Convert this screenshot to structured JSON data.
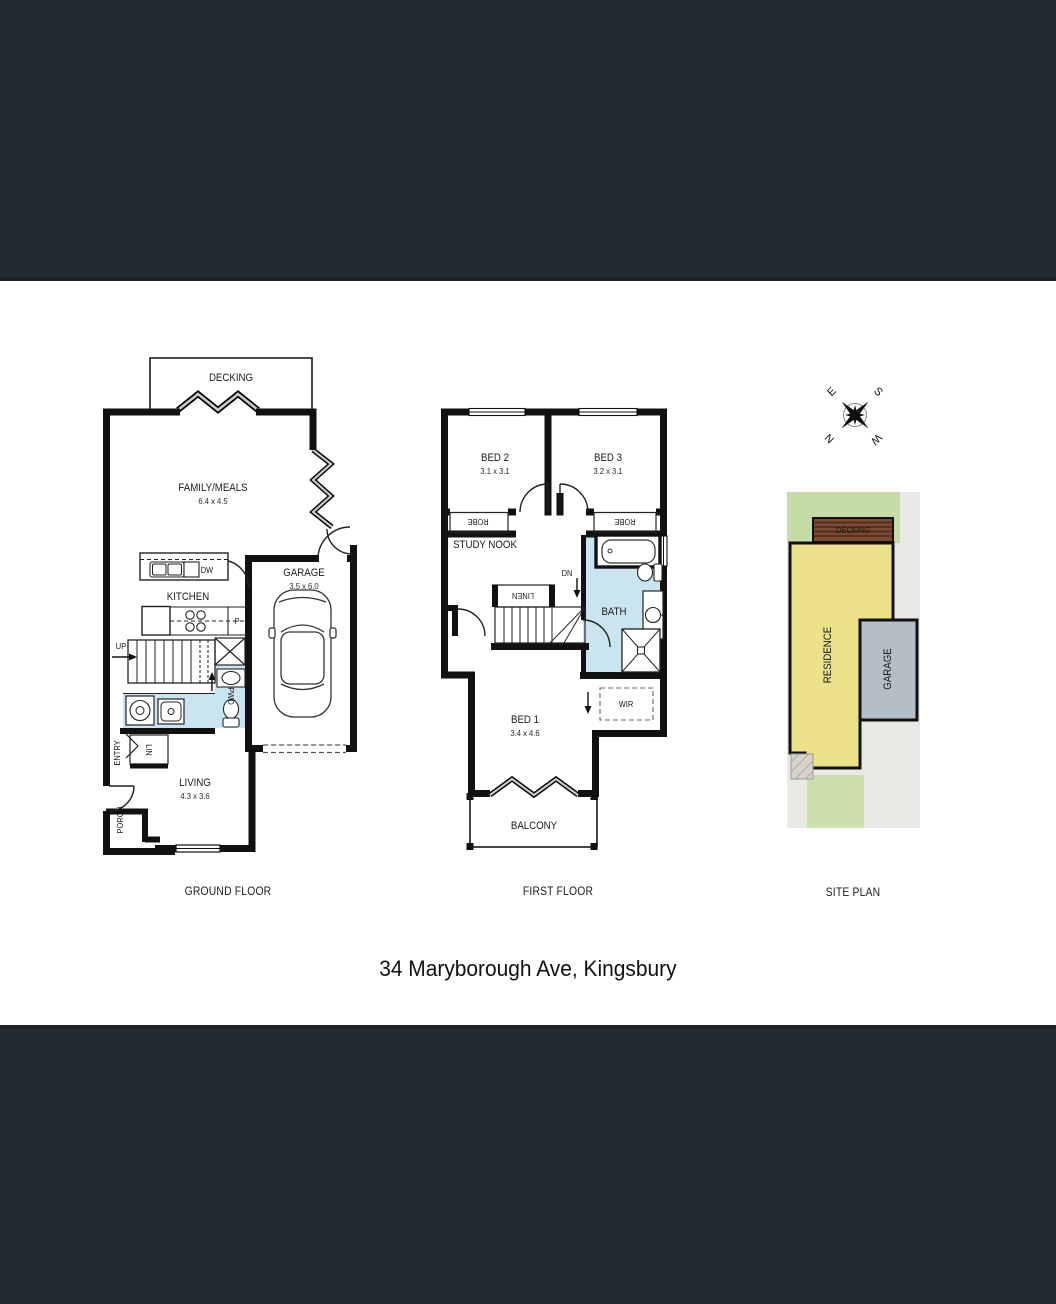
{
  "ground": {
    "title": "GROUND FLOOR",
    "decking": "DECKING",
    "family": "FAMILY/MEALS",
    "family_dims": "6.4 x 4.5",
    "kitchen": "KITCHEN",
    "dw": "DW",
    "pantry": "P",
    "up": "UP",
    "pwd": "PWD",
    "lin": "LIN",
    "entry": "ENTRY",
    "porch": "PORCH",
    "living": "LIVING",
    "living_dims": "4.3 x 3.6",
    "garage": "GARAGE",
    "garage_dims": "3.5 x 6.0"
  },
  "first": {
    "title": "FIRST FLOOR",
    "bed2": "BED 2",
    "bed2_dims": "3.1 x 3.1",
    "bed3": "BED 3",
    "bed3_dims": "3.2 x 3.1",
    "robe": "ROBE",
    "study_nook": "STUDY NOOK",
    "linen": "LINEN",
    "dn": "DN",
    "bath": "BATH",
    "bed1": "BED 1",
    "bed1_dims": "3.4 x 4.6",
    "wir": "WIR",
    "balcony": "BALCONY"
  },
  "site": {
    "title": "SITE PLAN",
    "decking": "DECKING",
    "residence": "RESIDENCE",
    "garage": "GARAGE"
  },
  "compass": {
    "n": "N",
    "s": "S",
    "e": "E",
    "w": "W"
  },
  "footer": {
    "address": "34 Maryborough Ave, Kingsbury"
  },
  "colors": {
    "band": "#232931",
    "wall": "#111111",
    "wet_area": "#cbe5f0",
    "site_grass": "#c5dca6",
    "site_grass_light": "#cbe0ac",
    "site_residence": "#ece289",
    "site_garage": "#b5bdc7",
    "site_decking": "#7a4a33",
    "site_paving": "#e9e9e5"
  }
}
